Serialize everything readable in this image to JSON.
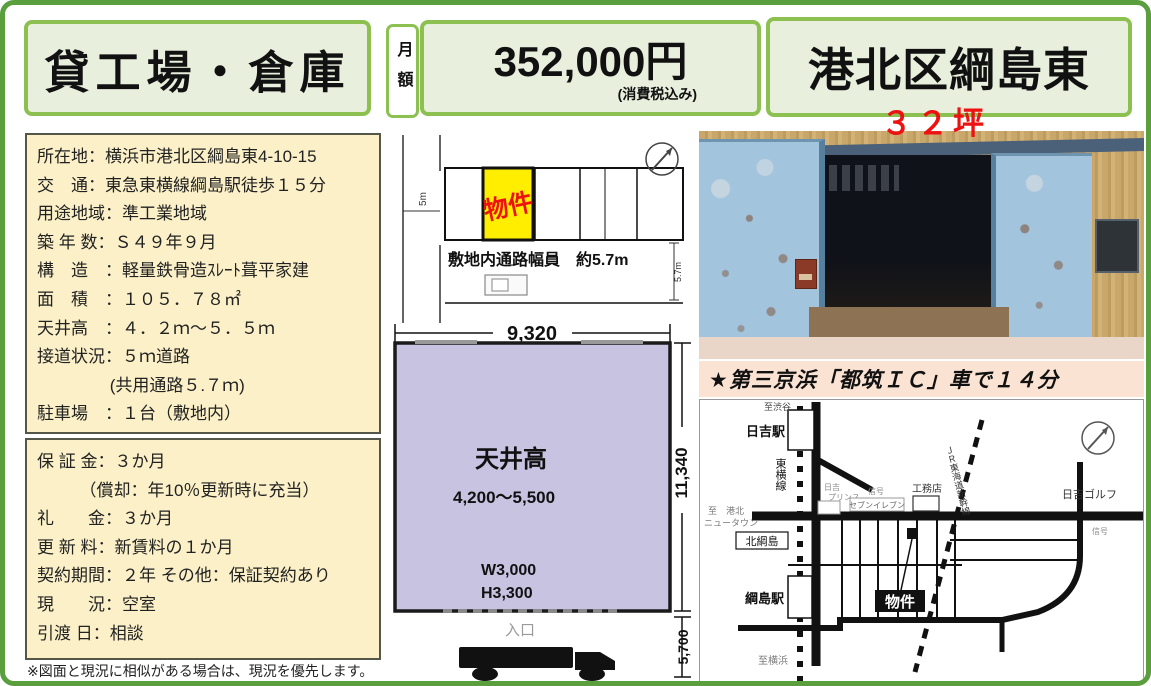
{
  "header": {
    "category": "貸工場・倉庫",
    "monthly_label": "月額",
    "price": "352,000円",
    "price_note": "(消費税込み)",
    "location": "港北区綱島東",
    "size_tsubo": "３２坪"
  },
  "property_info": {
    "lines": [
      "所在地：横浜市港北区綱島東4-10-15",
      "交　通：東急東横線綱島駅徒歩１５分",
      "用途地域：準工業地域",
      "築 年 数：Ｓ４９年９月",
      "構　造　：軽量鉄骨造ｽﾚｰﾄ葺平家建",
      "面　積　：１０５．７８㎡",
      "天井高　：４．２ｍ～５．５ｍ",
      "接道状況：５ｍ道路",
      "　　　　 (共用通路５.７ｍ)",
      "駐車場　：１台（敷地内）"
    ]
  },
  "contract_info": {
    "lines": [
      "保 証 金：３か月",
      "　　　（償却：年10％更新時に充当）",
      "礼　　金：３か月",
      "更 新 料：新賃料の１か月",
      "契約期間：２年 その他：保証契約あり",
      "現　　況：空室",
      "引渡 日：相談"
    ]
  },
  "disclaimer": "※図面と現況に相似がある場合は、現況を優先します。",
  "site_plan": {
    "road_width": "5m",
    "unit_label": "物件",
    "passage_note": "敷地内通路幅員　約5.7m",
    "passage_width": "5.7m"
  },
  "floor_plan": {
    "width_dim": "9,320",
    "depth_dim": "11,340",
    "ceiling_label": "天井高",
    "ceiling_range": "4,200～5,500",
    "opening_w": "W3,000",
    "opening_h": "H3,300",
    "entrance": "入口",
    "frontage_dim": "5,700"
  },
  "access_note": "★第三京浜「都筑ＩＣ」車で１４分",
  "map": {
    "to_shibuya": "至渋谷",
    "hiyoshi_station": "日吉駅",
    "toyoko_line": "東横線",
    "shinkansen": "ＪＲ東海道新幹線",
    "hiyoshi_prince_1": "日吉",
    "hiyoshi_prince_2": "プリンス",
    "signal_1": "信号",
    "signal_2": "信号",
    "koumuten": "工務店",
    "seven_eleven": "セブンイレブン",
    "hiyoshi_golf": "日吉ゴルフ",
    "to_kohoku_1": "至　港北",
    "to_kohoku_2": "ニュータウン",
    "kita_tsunashima": "北綱島",
    "tsunashima_station": "綱島駅",
    "to_yokohama": "至横浜",
    "property_label": "物件"
  },
  "colors": {
    "page_border_green": "#5a9e3d",
    "header_border_green": "#8cc152",
    "header_fill": "#e9efdd",
    "info_fill": "#fbf0c7",
    "plan_fill": "#c7c3e1",
    "access_band_fill": "#fbe3d4",
    "highlight_yellow": "#ffee00",
    "accent_red": "#ee1111"
  }
}
